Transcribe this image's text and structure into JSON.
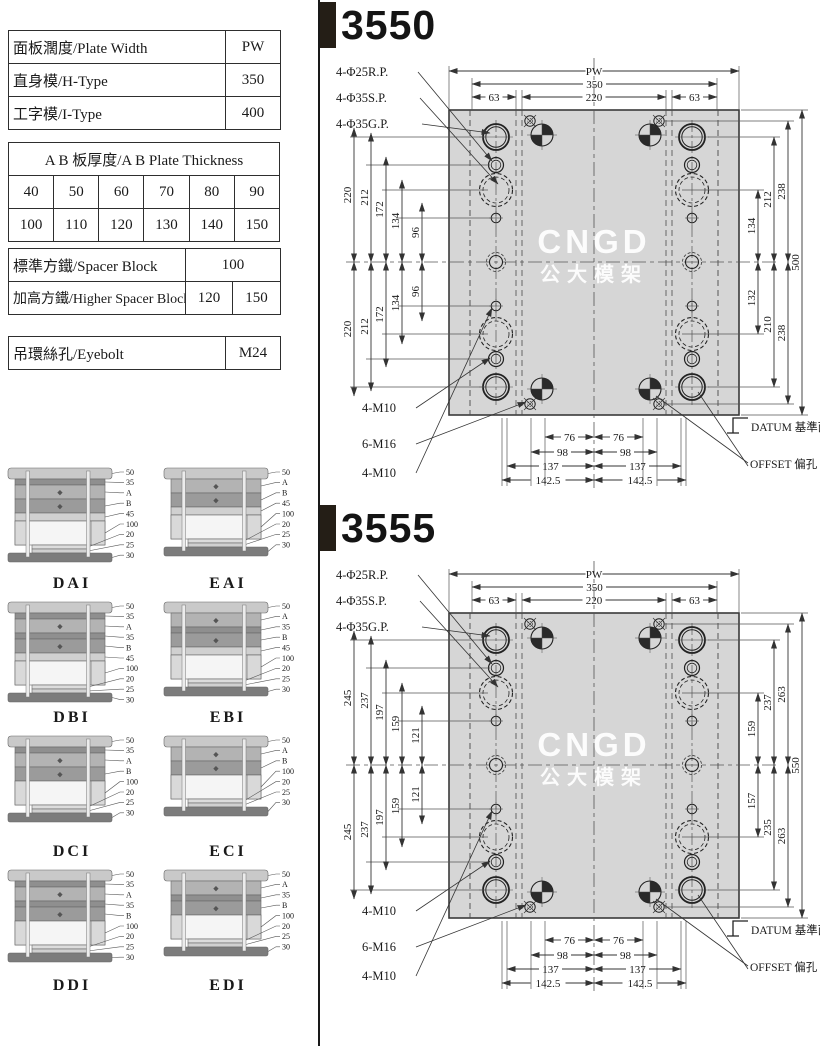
{
  "page": {
    "width": 820,
    "height": 1046
  },
  "colors": {
    "plate_fill": "#d6d6d6",
    "line": "#333333",
    "title": "#141414",
    "bar": "#241e16",
    "watermark": "#ffffff"
  },
  "spec_table": {
    "basic_rows": [
      {
        "label": "面板濶度/Plate Width",
        "value": "PW"
      },
      {
        "label": "直身模/H-Type",
        "value": "350"
      },
      {
        "label": "工字模/I-Type",
        "value": "400"
      }
    ],
    "thickness": {
      "header": "A B 板厚度/A B Plate Thickness",
      "row1": [
        "40",
        "50",
        "60",
        "70",
        "80",
        "90"
      ],
      "row2": [
        "100",
        "110",
        "120",
        "130",
        "140",
        "150"
      ]
    },
    "spacer": {
      "standard_label": "標準方鐵/Spacer Block",
      "standard_value": "100",
      "higher_label": "加高方鐵/Higher Spacer Block",
      "higher_values": [
        "120",
        "150"
      ]
    },
    "eyebolt": {
      "label": "吊環絲孔/Eyebolt",
      "value": "M24"
    }
  },
  "mold_types": [
    {
      "name": "DAI",
      "labels": [
        "50",
        "35",
        "A",
        "B",
        "45",
        "100",
        "20",
        "25",
        "30"
      ]
    },
    {
      "name": "EAI",
      "labels": [
        "50",
        "A",
        "B",
        "45",
        "100",
        "20",
        "25",
        "30"
      ]
    },
    {
      "name": "DBI",
      "labels": [
        "50",
        "35",
        "A",
        "35",
        "B",
        "45",
        "100",
        "20",
        "25",
        "30"
      ]
    },
    {
      "name": "EBI",
      "labels": [
        "50",
        "A",
        "35",
        "B",
        "45",
        "100",
        "20",
        "25",
        "30"
      ]
    },
    {
      "name": "DCI",
      "labels": [
        "50",
        "35",
        "A",
        "B",
        "100",
        "20",
        "25",
        "30"
      ]
    },
    {
      "name": "ECI",
      "labels": [
        "50",
        "A",
        "B",
        "100",
        "20",
        "25",
        "30"
      ]
    },
    {
      "name": "DDI",
      "labels": [
        "50",
        "35",
        "A",
        "35",
        "B",
        "100",
        "20",
        "25",
        "30"
      ]
    },
    {
      "name": "EDI",
      "labels": [
        "50",
        "A",
        "35",
        "B",
        "100",
        "20",
        "25",
        "30"
      ]
    }
  ],
  "drawings": [
    {
      "id": "3550",
      "hole_callouts": [
        "4-Φ25R.P.",
        "4-Φ35S.P.",
        "4-Φ35G.P."
      ],
      "screw_callouts": [
        "4-M10",
        "6-M16",
        "4-M10"
      ],
      "datum_label": "DATUM 基準面",
      "offset_label": "OFFSET 偏孔",
      "watermark_line1": "CNGD",
      "watermark_line2": "公大模架",
      "top_dims": {
        "pw": "PW",
        "span350": "350",
        "span220": "220",
        "left63": "63",
        "right63": "63"
      },
      "left_dims": [
        "220",
        "212",
        "172",
        "134",
        "96"
      ],
      "right_dims_top": [
        "134",
        "212",
        "238"
      ],
      "right_dims_bottom": [
        "132",
        "210",
        "238"
      ],
      "overall_height": "500",
      "bottom_dims": [
        "76",
        "98",
        "137",
        "142.5"
      ]
    },
    {
      "id": "3555",
      "hole_callouts": [
        "4-Φ25R.P.",
        "4-Φ35S.P.",
        "4-Φ35G.P."
      ],
      "screw_callouts": [
        "4-M10",
        "6-M16",
        "4-M10"
      ],
      "datum_label": "DATUM 基準面",
      "offset_label": "OFFSET 偏孔",
      "watermark_line1": "CNGD",
      "watermark_line2": "公大模架",
      "top_dims": {
        "pw": "PW",
        "span350": "350",
        "span220": "220",
        "left63": "63",
        "right63": "63"
      },
      "left_dims": [
        "245",
        "237",
        "197",
        "159",
        "121"
      ],
      "right_dims_top": [
        "159",
        "237",
        "263"
      ],
      "right_dims_bottom": [
        "157",
        "235",
        "263"
      ],
      "overall_height": "550",
      "bottom_dims": [
        "76",
        "98",
        "137",
        "142.5"
      ]
    }
  ]
}
